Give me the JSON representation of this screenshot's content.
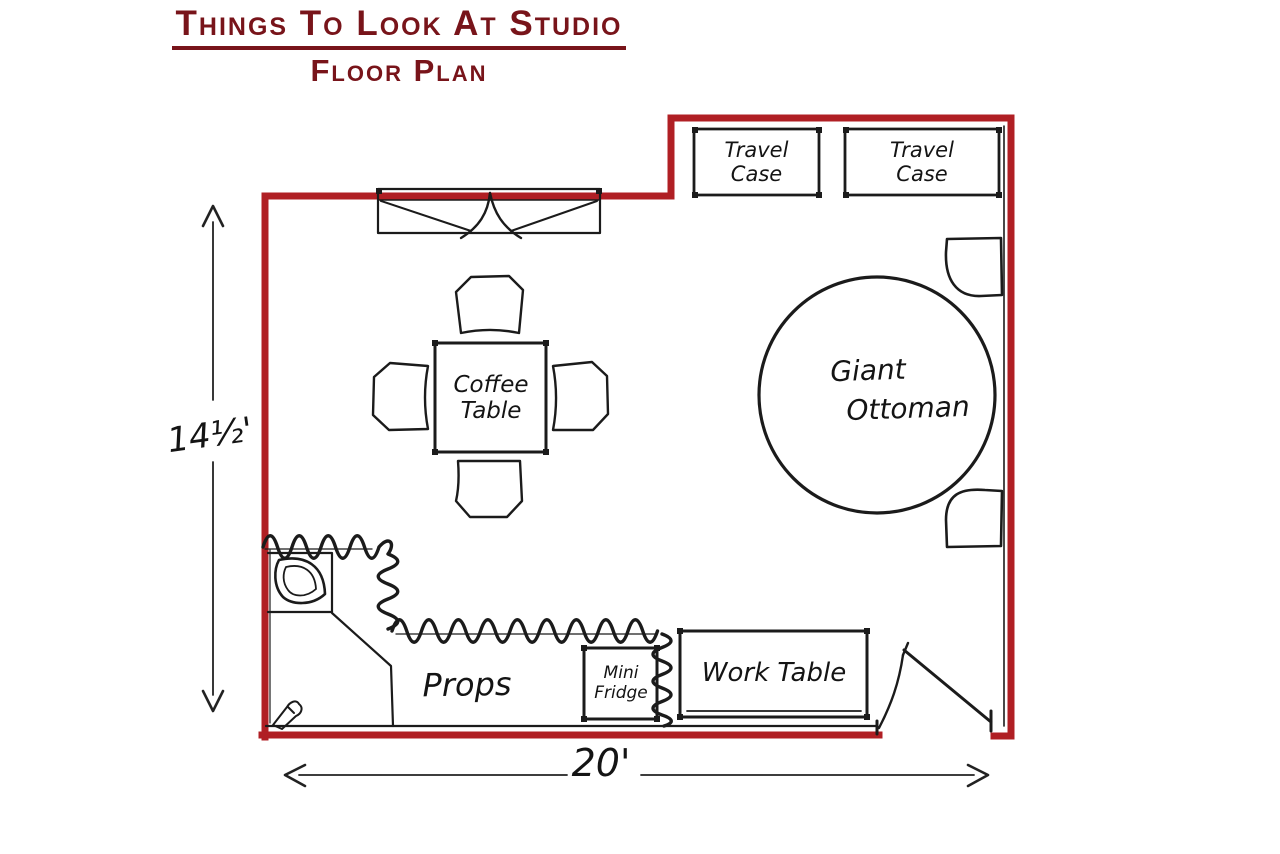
{
  "header": {
    "title": "Things To Look At Studio",
    "subtitle": "Floor Plan"
  },
  "floor_plan": {
    "labels": {
      "travel_case_1": {
        "line1": "Travel",
        "line2": "Case"
      },
      "travel_case_2": {
        "line1": "Travel",
        "line2": "Case"
      },
      "giant_ottoman": {
        "line1": "Giant",
        "line2": "Ottoman"
      },
      "coffee_table": {
        "line1": "Coffee",
        "line2": "Table"
      },
      "props": "Props",
      "mini_fridge": {
        "line1": "Mini",
        "line2": "Fridge"
      },
      "work_table": "Work Table"
    },
    "dimensions": {
      "height": "14½'",
      "width": "20'"
    }
  },
  "colors": {
    "wall": "#b01f24",
    "title": "#78141a",
    "ink": "#1b1b1b"
  }
}
